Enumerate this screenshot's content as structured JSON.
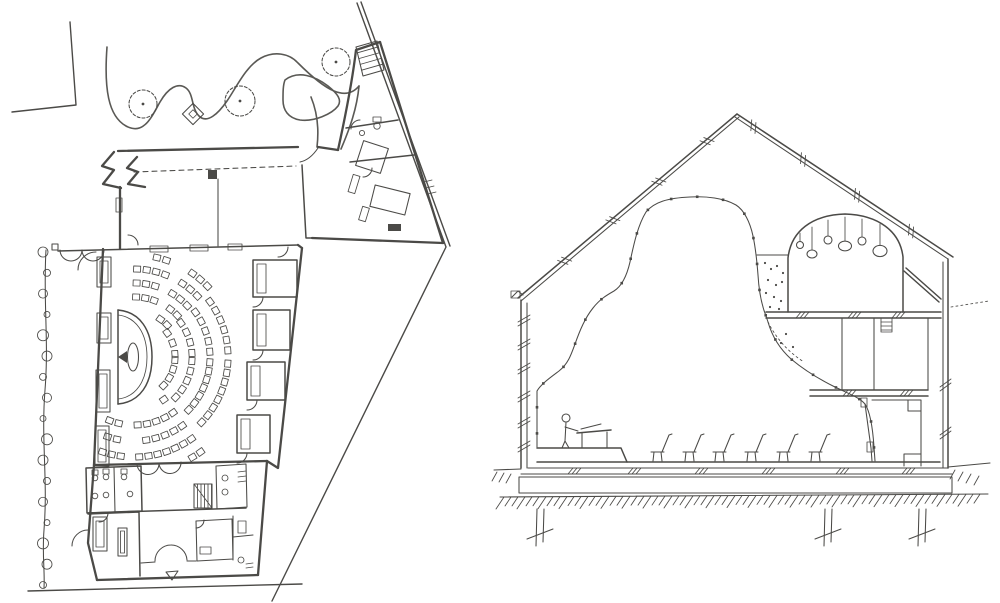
{
  "meta": {
    "colors": {
      "paper": "#ffffff",
      "ink": "#4b4a47",
      "ink_light": "#5a5955"
    },
    "drawing": {
      "left": "site-and-floor-plan",
      "right": "building-cross-section"
    }
  },
  "plan": {
    "trees": [
      {
        "x": 143,
        "y": 104,
        "r": 14
      },
      {
        "x": 240,
        "y": 101,
        "r": 15
      },
      {
        "x": 336,
        "y": 62,
        "r": 14
      }
    ],
    "hedge": {
      "x": 45,
      "y0": 252,
      "y1": 585,
      "count": 17
    },
    "seating": {
      "center": {
        "x": 134,
        "y": 357
      },
      "seat": {
        "w": 7,
        "h": 6
      },
      "arc_step": 9.6,
      "bounds": {
        "x0": 102,
        "x1": 231,
        "y0": 256,
        "y1": 458
      },
      "stage_box": {
        "x0": 95,
        "x1": 158,
        "y0": 302,
        "y1": 412
      },
      "banks": [
        {
          "a0": -88,
          "a1": -44,
          "radii": [
            46,
            60,
            74,
            88,
            102
          ],
          "gap": [
            -68,
            -60
          ]
        },
        {
          "a0": -36,
          "a1": -4,
          "radii": [
            24,
            41,
            58,
            76,
            94
          ]
        },
        {
          "a0": 4,
          "a1": 44,
          "radii": [
            24,
            41,
            58,
            76,
            94
          ]
        },
        {
          "a0": 55,
          "a1": 135,
          "radii": [
            52,
            68,
            84,
            100,
            116
          ],
          "gap": [
            88,
            96
          ]
        }
      ]
    },
    "window_boxes": [
      {
        "x": 97,
        "y": 257,
        "w": 14,
        "h": 30
      },
      {
        "x": 97,
        "y": 313,
        "w": 14,
        "h": 30
      },
      {
        "x": 96,
        "y": 370,
        "w": 14,
        "h": 42
      },
      {
        "x": 95,
        "y": 426,
        "w": 14,
        "h": 40
      },
      {
        "x": 93,
        "y": 517,
        "w": 14,
        "h": 34
      }
    ],
    "top_wall_fixtures": [
      {
        "x": 150,
        "y": 246,
        "w": 18,
        "h": 6
      },
      {
        "x": 190,
        "y": 245,
        "w": 18,
        "h": 6
      },
      {
        "x": 228,
        "y": 244,
        "w": 14,
        "h": 6
      }
    ],
    "right_rooms": [
      {
        "x": 253,
        "y": 260,
        "w": 44,
        "h": 37
      },
      {
        "x": 253,
        "y": 310,
        "w": 37,
        "h": 40
      },
      {
        "x": 247,
        "y": 362,
        "w": 38,
        "h": 38
      },
      {
        "x": 237,
        "y": 415,
        "w": 33,
        "h": 38
      }
    ],
    "wc_fixtures": [
      {
        "x": 95,
        "y": 470,
        "d": 1
      },
      {
        "x": 106,
        "y": 469,
        "d": 1
      },
      {
        "x": 124,
        "y": 469,
        "d": 1
      },
      {
        "x": 95,
        "y": 504,
        "d": -1
      },
      {
        "x": 106,
        "y": 503,
        "d": -1
      },
      {
        "x": 130,
        "y": 502,
        "d": -1
      }
    ]
  },
  "section": {
    "roof": {
      "left": [
        [
          518,
          298
        ],
        [
          737,
          114
        ]
      ],
      "right": [
        [
          737,
          114
        ],
        [
          953,
          257
        ]
      ]
    },
    "roof_ticks": {
      "left": [
        0.2,
        0.42,
        0.63,
        0.85
      ],
      "right": [
        0.07,
        0.3,
        0.55,
        0.8
      ]
    },
    "ceiling_dot_count": 26,
    "wall_ticks": [
      318,
      342,
      366,
      394,
      420,
      444
    ],
    "right_wall_ticks": [
      382,
      430
    ],
    "chairs": [
      652,
      684,
      714,
      746,
      778,
      810
    ],
    "pendants": [
      {
        "x": 800,
        "top": 233,
        "cy": 245,
        "r": 3.5,
        "squash": 1
      },
      {
        "x": 812,
        "top": 227,
        "cy": 254,
        "r": 5,
        "squash": 0.8
      },
      {
        "x": 828,
        "top": 220,
        "cy": 240,
        "r": 4,
        "squash": 1
      },
      {
        "x": 845,
        "top": 217,
        "cy": 246,
        "r": 6.5,
        "squash": 0.75
      },
      {
        "x": 862,
        "top": 219,
        "cy": 241,
        "r": 4,
        "squash": 1
      },
      {
        "x": 880,
        "top": 224,
        "cy": 251,
        "r": 7,
        "squash": 0.8
      }
    ],
    "pocket_dots": [
      [
        765,
        263
      ],
      [
        771,
        269
      ],
      [
        777,
        266
      ],
      [
        783,
        273
      ],
      [
        768,
        280
      ],
      [
        776,
        285
      ],
      [
        782,
        282
      ],
      [
        766,
        293
      ],
      [
        774,
        297
      ],
      [
        781,
        301
      ],
      [
        770,
        307
      ],
      [
        779,
        309
      ],
      [
        786,
        334
      ],
      [
        781,
        343
      ],
      [
        793,
        347
      ]
    ],
    "floor_hatch_x": [
      568,
      628,
      695,
      762,
      836,
      902
    ],
    "loft_hatch_x": [
      796,
      848,
      892
    ],
    "slab_hatch_x": [
      843,
      900
    ],
    "ground_hatch": {
      "x0": 504,
      "x1": 984,
      "step": 7
    },
    "left_hatch": [
      [
        497,
        472
      ],
      [
        504,
        473
      ],
      [
        511,
        474
      ]
    ],
    "right_hatch": [
      [
        955,
        470
      ],
      [
        963,
        472
      ],
      [
        971,
        474
      ],
      [
        979,
        476
      ]
    ],
    "piles": [
      540,
      828,
      922
    ]
  }
}
